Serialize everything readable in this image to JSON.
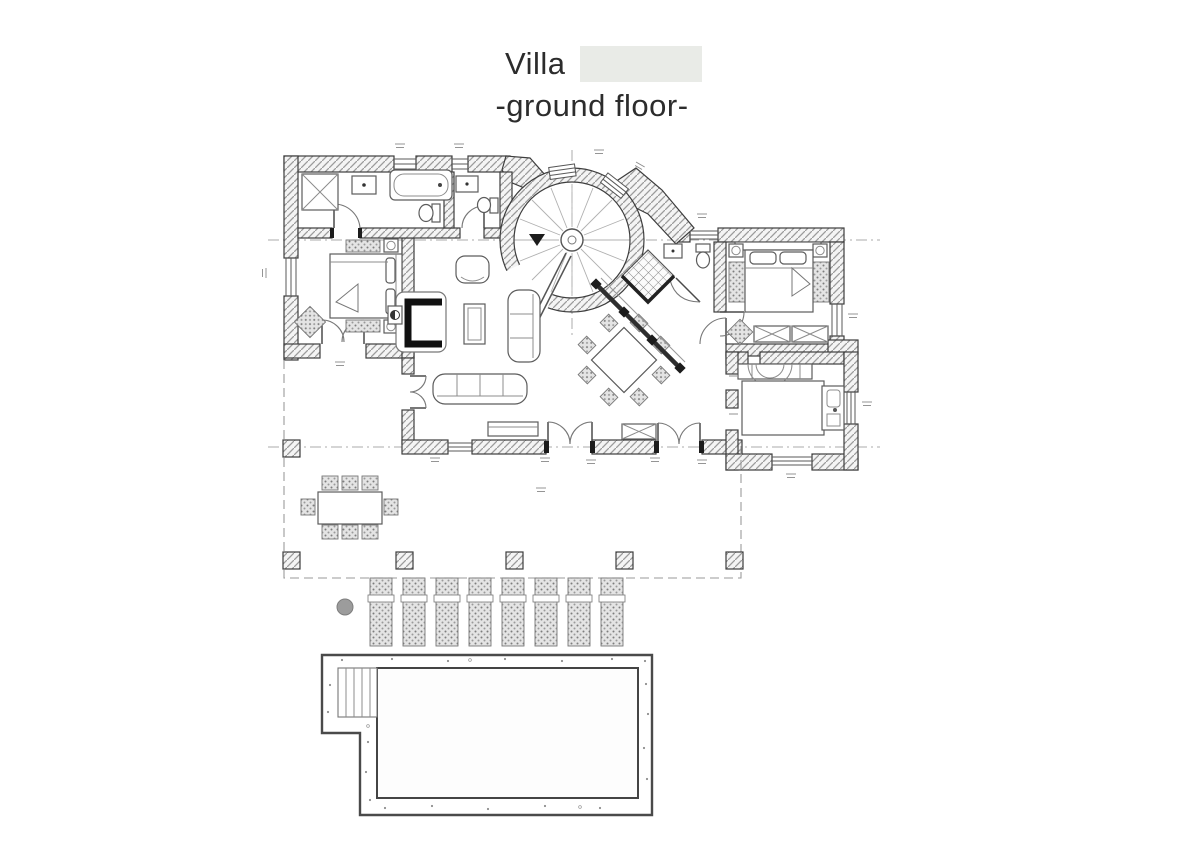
{
  "title": {
    "line1": "Villa",
    "line2": "-ground floor-",
    "redacted_name": "",
    "redaction_color": "#e9ebe7",
    "text_color": "#2c2c2c"
  },
  "plan": {
    "type": "architectural-floor-plan",
    "colors": {
      "background": "#ffffff",
      "wall_outline": "#3d3d3d",
      "wall_hatch": "#9b9b9b",
      "wall_fill": "#f4f4f4",
      "furniture_line": "#5c5c5c",
      "light_line": "#8c8c8c",
      "dashed_reference": "#9a9a9a",
      "stipple_fill": "#e4e4e4",
      "stipple_dot": "#7d7d7d",
      "black_accent": "#1c1c1c",
      "parasol_base": "#9c9c9c"
    },
    "rooms": [
      "bathroom",
      "wc",
      "bedroom-left",
      "living-room",
      "spiral-staircase-tower",
      "shower-room",
      "corridor",
      "bedroom-right",
      "kitchen",
      "terrace",
      "pool-deck"
    ],
    "symbols": [
      "bathtub",
      "washbasin",
      "toilet",
      "shaft",
      "double-bed",
      "nightstand",
      "wall-lamp",
      "plant",
      "fireplace",
      "armchair",
      "coffee-table",
      "sofa",
      "dining-table",
      "wardrobe",
      "kitchen-island",
      "cooker-hood",
      "sink",
      "french-door",
      "window",
      "terrace-column",
      "outdoor-dining-table",
      "outdoor-chair",
      "sun-lounger",
      "parasol-base",
      "pool-steps",
      "pool-basin"
    ],
    "counts": {
      "sun_loungers": 8,
      "terrace_columns": 6,
      "indoor_dining_chairs": 8,
      "outdoor_dining_chairs": 8,
      "stair_treads": 16
    },
    "dimension_marks_legible": false
  }
}
